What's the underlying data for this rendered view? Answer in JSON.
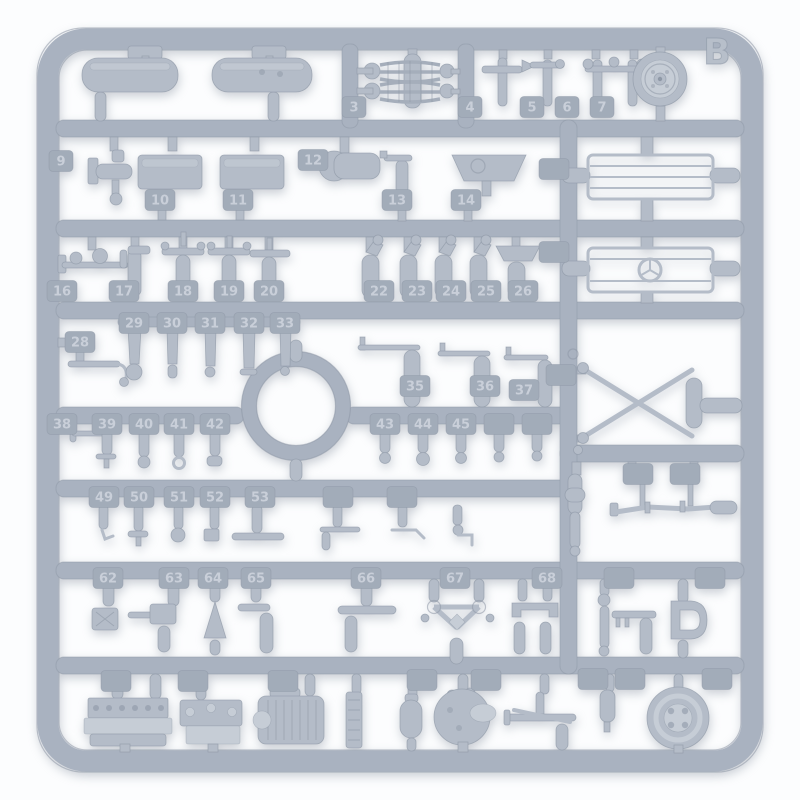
{
  "photo": {
    "sprue_label": "B",
    "colors": {
      "background": "#fcfdfe",
      "plastic_rail": "#a9b2c0",
      "plastic_part": "#b4bcc8",
      "plastic_highlight": "#c6cdd6",
      "plastic_shadow": "#8e98a6",
      "tag_plate": "#a2acb9",
      "tag_text": "#c9cfd9",
      "label_text": "#b7bfca"
    },
    "tags": [
      {
        "n": "3",
        "x": 354,
        "y": 107
      },
      {
        "n": "4",
        "x": 470,
        "y": 107
      },
      {
        "n": "5",
        "x": 532,
        "y": 107
      },
      {
        "n": "6",
        "x": 567,
        "y": 107
      },
      {
        "n": "7",
        "x": 602,
        "y": 107
      },
      {
        "n": "9",
        "x": 61,
        "y": 161
      },
      {
        "n": "10",
        "x": 160,
        "y": 200
      },
      {
        "n": "11",
        "x": 238,
        "y": 200
      },
      {
        "n": "12",
        "x": 313,
        "y": 160
      },
      {
        "n": "13",
        "x": 397,
        "y": 200
      },
      {
        "n": "14",
        "x": 466,
        "y": 200
      },
      {
        "n": "",
        "x": 554,
        "y": 169
      },
      {
        "n": "16",
        "x": 62,
        "y": 291
      },
      {
        "n": "17",
        "x": 124,
        "y": 291
      },
      {
        "n": "18",
        "x": 183,
        "y": 291
      },
      {
        "n": "19",
        "x": 229,
        "y": 291
      },
      {
        "n": "20",
        "x": 269,
        "y": 291
      },
      {
        "n": "22",
        "x": 379,
        "y": 291
      },
      {
        "n": "23",
        "x": 417,
        "y": 291
      },
      {
        "n": "24",
        "x": 451,
        "y": 291
      },
      {
        "n": "25",
        "x": 486,
        "y": 291
      },
      {
        "n": "26",
        "x": 523,
        "y": 291
      },
      {
        "n": "",
        "x": 554,
        "y": 252
      },
      {
        "n": "28",
        "x": 80,
        "y": 342
      },
      {
        "n": "29",
        "x": 134,
        "y": 323
      },
      {
        "n": "30",
        "x": 172,
        "y": 323
      },
      {
        "n": "31",
        "x": 210,
        "y": 323
      },
      {
        "n": "32",
        "x": 249,
        "y": 323
      },
      {
        "n": "33",
        "x": 285,
        "y": 323
      },
      {
        "n": "35",
        "x": 415,
        "y": 386
      },
      {
        "n": "36",
        "x": 485,
        "y": 386
      },
      {
        "n": "37",
        "x": 524,
        "y": 390
      },
      {
        "n": "",
        "x": 561,
        "y": 375
      },
      {
        "n": "38",
        "x": 62,
        "y": 424
      },
      {
        "n": "39",
        "x": 107,
        "y": 424
      },
      {
        "n": "40",
        "x": 144,
        "y": 424
      },
      {
        "n": "41",
        "x": 179,
        "y": 424
      },
      {
        "n": "42",
        "x": 215,
        "y": 424
      },
      {
        "n": "43",
        "x": 385,
        "y": 424
      },
      {
        "n": "44",
        "x": 423,
        "y": 424
      },
      {
        "n": "45",
        "x": 461,
        "y": 424
      },
      {
        "n": "",
        "x": 499,
        "y": 424
      },
      {
        "n": "",
        "x": 537,
        "y": 424
      },
      {
        "n": "49",
        "x": 104,
        "y": 497
      },
      {
        "n": "50",
        "x": 139,
        "y": 497
      },
      {
        "n": "51",
        "x": 179,
        "y": 497
      },
      {
        "n": "52",
        "x": 215,
        "y": 497
      },
      {
        "n": "53",
        "x": 260,
        "y": 497
      },
      {
        "n": "",
        "x": 338,
        "y": 497
      },
      {
        "n": "",
        "x": 402,
        "y": 497
      },
      {
        "n": "",
        "x": 638,
        "y": 474
      },
      {
        "n": "",
        "x": 685,
        "y": 474
      },
      {
        "n": "62",
        "x": 108,
        "y": 578
      },
      {
        "n": "63",
        "x": 174,
        "y": 578
      },
      {
        "n": "64",
        "x": 213,
        "y": 578
      },
      {
        "n": "65",
        "x": 256,
        "y": 578
      },
      {
        "n": "66",
        "x": 366,
        "y": 578
      },
      {
        "n": "67",
        "x": 455,
        "y": 578
      },
      {
        "n": "68",
        "x": 547,
        "y": 578
      },
      {
        "n": "",
        "x": 619,
        "y": 578
      },
      {
        "n": "",
        "x": 710,
        "y": 578
      },
      {
        "n": "",
        "x": 116,
        "y": 681
      },
      {
        "n": "",
        "x": 193,
        "y": 681
      },
      {
        "n": "",
        "x": 283,
        "y": 681
      },
      {
        "n": "",
        "x": 422,
        "y": 680
      },
      {
        "n": "",
        "x": 486,
        "y": 680
      },
      {
        "n": "",
        "x": 593,
        "y": 679
      },
      {
        "n": "",
        "x": 630,
        "y": 679
      },
      {
        "n": "",
        "x": 717,
        "y": 679
      }
    ]
  }
}
